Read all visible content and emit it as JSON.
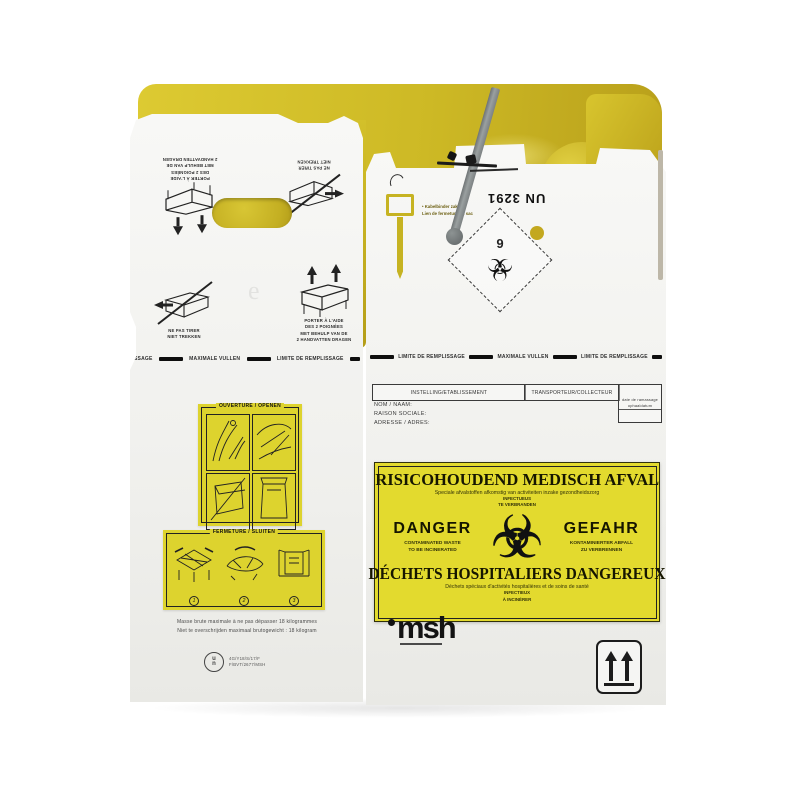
{
  "colors": {
    "bag_yellow": "#cdb925",
    "label_yellow": "#e3da2e",
    "cardboard": "#f1f1ee",
    "tie_grey": "#8a9090",
    "ink": "#1c1c1c"
  },
  "handling": {
    "carry_fr1": "PORTER À L'AIDE",
    "carry_fr2": "DES 2 POIGNÉES",
    "carry_nl1": "MET BEHULP VAN DE",
    "carry_nl2": "2 HANDVATTEN DRAGEN",
    "nopull_fr": "NE PAS TIRER",
    "nopull_nl": "NIET TREKKEN"
  },
  "fill_limit": {
    "fr": "LIMITE DE REMPLISSAGE",
    "nl": "MAXIMALE VULLEN",
    "partial": "SSAGE"
  },
  "opening_panel": {
    "title": "OUVERTURE / OPENEN"
  },
  "closing_panel": {
    "title": "FERMETURE / SLUITEN",
    "step1": "1",
    "step2": "2",
    "step3": "3"
  },
  "weight_note": {
    "fr": "Masse brute maximale à ne pas dépasser 18 kilogrammes",
    "nl": "Niet te overschrijden maximaal brutogewicht : 18 kilogram"
  },
  "un_certification": {
    "mark_u": "u",
    "mark_n": "n",
    "line1": "4G/Y18/S/17/F",
    "line2": "F/BVT/2677/MSH"
  },
  "closure": {
    "note1": "• Kabelbinder zak",
    "note2": "Lien de fermeture du sac"
  },
  "un_number": "UN 3291",
  "class_diamond": {
    "number": "6",
    "symbol": "☣"
  },
  "consignment_form": {
    "org": "INSTELLING/ETABLISSEMENT",
    "transporter": "TRANSPORTEUR/COLLECTEUR",
    "date1": "date de ramassage",
    "date2": "ophaaldatum",
    "name": "NOM / NAAM:",
    "company": "RAISON SOCIALE:",
    "address": "ADRESSE / ADRES:"
  },
  "hazard_label": {
    "title_nl": "RISICOHOUDEND MEDISCH AFVAL",
    "subtitle_nl": "Speciale afvalstoffen afkomstig van activiteiten inzake gezondheidszorg",
    "inf_nl1": "INFECTUEUS",
    "inf_nl2": "TE VERBRANDEN",
    "danger": "DANGER",
    "danger_sub1": "CONTAMINATED WASTE",
    "danger_sub2": "TO BE INCINERATED",
    "gefahr": "GEFAHR",
    "gefahr_sub1": "KONTAMINIERTER ABFALL",
    "gefahr_sub2": "ZU VERBRENNEN",
    "biohazard": "☣",
    "title_fr": "DÉCHETS HOSPITALIERS DANGEREUX",
    "subtitle_fr": "Déchets spéciaux d'activités hospitalières et de soins de santé",
    "inf_fr1": "INFECTIEUX",
    "inf_fr2": "À INCINÉRER"
  },
  "brand": {
    "logo": "msh"
  },
  "diamond_class_label": "6"
}
